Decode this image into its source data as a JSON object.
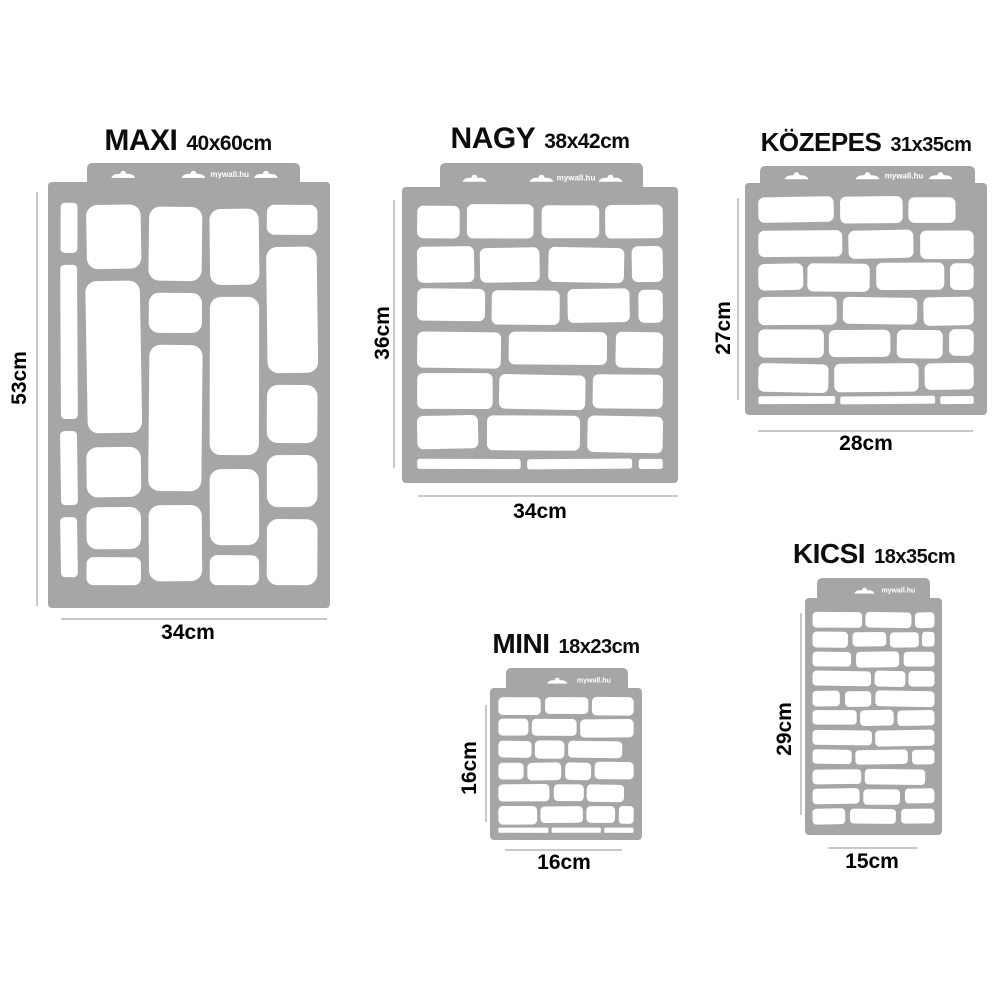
{
  "colors": {
    "stencil": "#a6a6a6",
    "cutout": "#ffffff",
    "dimension_line": "#c9c9c9",
    "title_text": "#0d0d0d",
    "watermark_text": "#ffffff"
  },
  "brand": {
    "watermark": "mywall.hu"
  },
  "products": [
    {
      "name": "MAXI",
      "size_label": "40x60cm",
      "height_label": "53cm",
      "width_label": "34cm",
      "layout": {
        "title": {
          "cx": 188,
          "top": 124,
          "name_fs": 30,
          "size_fs": 21
        },
        "tab": {
          "x": 87,
          "y": 163,
          "w": 213,
          "slots": 3
        },
        "body": {
          "x": 48,
          "y": 182,
          "w": 282,
          "h": 426
        },
        "vdim": {
          "x": 36,
          "y1": 192,
          "y2": 606,
          "lcx": 20,
          "lcy": 378
        },
        "hdim": {
          "y": 618,
          "x1": 61,
          "x2": 327,
          "lcx": 188,
          "lcy": 633
        }
      },
      "pattern": {
        "type": "stones",
        "stones": [
          [
            0.005,
            0.02,
            0.065,
            0.125
          ],
          [
            0.005,
            0.175,
            0.065,
            0.385
          ],
          [
            0.005,
            0.59,
            0.065,
            0.185
          ],
          [
            0.005,
            0.805,
            0.065,
            0.15
          ],
          [
            0.105,
            0.025,
            0.21,
            0.16
          ],
          [
            0.105,
            0.215,
            0.21,
            0.38
          ],
          [
            0.105,
            0.63,
            0.21,
            0.125
          ],
          [
            0.105,
            0.78,
            0.21,
            0.105
          ],
          [
            0.105,
            0.905,
            0.21,
            0.07
          ],
          [
            0.345,
            0.03,
            0.205,
            0.185
          ],
          [
            0.345,
            0.245,
            0.205,
            0.1
          ],
          [
            0.345,
            0.375,
            0.205,
            0.365
          ],
          [
            0.345,
            0.775,
            0.205,
            0.19
          ],
          [
            0.58,
            0.035,
            0.19,
            0.19
          ],
          [
            0.58,
            0.255,
            0.19,
            0.395
          ],
          [
            0.58,
            0.685,
            0.19,
            0.19
          ],
          [
            0.58,
            0.9,
            0.19,
            0.075
          ],
          [
            0.8,
            0.025,
            0.195,
            0.075
          ],
          [
            0.8,
            0.13,
            0.195,
            0.315
          ],
          [
            0.8,
            0.475,
            0.195,
            0.145
          ],
          [
            0.8,
            0.65,
            0.195,
            0.13
          ],
          [
            0.8,
            0.81,
            0.195,
            0.165
          ]
        ]
      }
    },
    {
      "name": "NAGY",
      "size_label": "38x42cm",
      "height_label": "36cm",
      "width_label": "34cm",
      "layout": {
        "title": {
          "cx": 540,
          "top": 122,
          "name_fs": 30,
          "size_fs": 21
        },
        "tab": {
          "x": 440,
          "y": 163,
          "w": 203,
          "slots": 3
        },
        "body": {
          "x": 402,
          "y": 187,
          "w": 276,
          "h": 296
        },
        "vdim": {
          "x": 393,
          "y1": 200,
          "y2": 468,
          "lcx": 383,
          "lcy": 333
        },
        "hdim": {
          "y": 495,
          "x1": 418,
          "x2": 678,
          "lcx": 540,
          "lcy": 512
        }
      },
      "pattern": {
        "type": "bricks",
        "rows": 6,
        "sliver": true,
        "seed": 7,
        "wmin": 0.17,
        "wrng": 0.25
      }
    },
    {
      "name": "KÖZEPES",
      "size_label": "31x35cm",
      "height_label": "27cm",
      "width_label": "28cm",
      "layout": {
        "title": {
          "cx": 866,
          "top": 127,
          "name_fs": 26,
          "size_fs": 20
        },
        "tab": {
          "x": 760,
          "y": 166,
          "w": 215,
          "slots": 3
        },
        "body": {
          "x": 745,
          "y": 183,
          "w": 242,
          "h": 232
        },
        "vdim": {
          "x": 737,
          "y1": 198,
          "y2": 400,
          "lcx": 724,
          "lcy": 328
        },
        "hdim": {
          "y": 430,
          "x1": 758,
          "x2": 973,
          "lcx": 866,
          "lcy": 444
        }
      },
      "pattern": {
        "type": "bricks",
        "rows": 6,
        "sliver": true,
        "seed": 3,
        "wmin": 0.17,
        "wrng": 0.25
      }
    },
    {
      "name": "MINI",
      "size_label": "18x23cm",
      "height_label": "16cm",
      "width_label": "16cm",
      "layout": {
        "title": {
          "cx": 566,
          "top": 628,
          "name_fs": 28,
          "size_fs": 20
        },
        "tab": {
          "x": 506,
          "y": 668,
          "w": 122,
          "slots": 1
        },
        "body": {
          "x": 490,
          "y": 688,
          "w": 152,
          "h": 152
        },
        "vdim": {
          "x": 485,
          "y1": 705,
          "y2": 822,
          "lcx": 470,
          "lcy": 768
        },
        "hdim": {
          "y": 849,
          "x1": 505,
          "x2": 622,
          "lcx": 564,
          "lcy": 863
        }
      },
      "pattern": {
        "type": "bricks",
        "rows": 6,
        "sliver": true,
        "seed": 11,
        "wmin": 0.18,
        "wrng": 0.26
      }
    },
    {
      "name": "KICSI",
      "size_label": "18x35cm",
      "height_label": "29cm",
      "width_label": "15cm",
      "layout": {
        "title": {
          "cx": 874,
          "top": 538,
          "name_fs": 28,
          "size_fs": 20
        },
        "tab": {
          "x": 817,
          "y": 578,
          "w": 113,
          "slots": 1
        },
        "body": {
          "x": 805,
          "y": 598,
          "w": 137,
          "h": 237
        },
        "vdim": {
          "x": 800,
          "y1": 613,
          "y2": 815,
          "lcx": 785,
          "lcy": 729
        },
        "hdim": {
          "y": 847,
          "x1": 828,
          "x2": 917,
          "lcx": 872,
          "lcy": 862
        }
      },
      "pattern": {
        "type": "bricks",
        "rows": 11,
        "sliver": false,
        "seed": 5,
        "wmin": 0.2,
        "wrng": 0.3
      }
    }
  ]
}
